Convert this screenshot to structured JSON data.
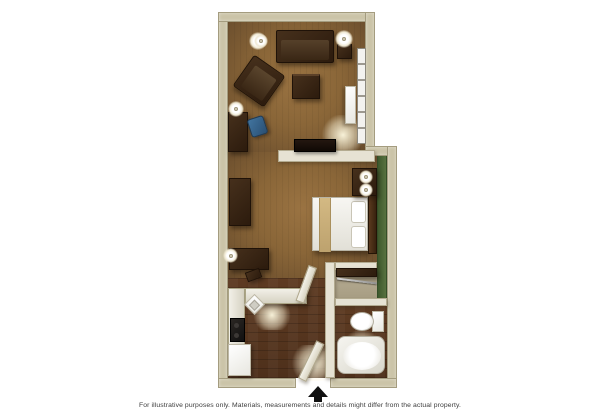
{
  "caption": "For illustrative purposes only.  Materials, measurements and details might differ from the actual property.",
  "floorplan": {
    "rooms": [
      "living-area",
      "bedroom",
      "kitchen",
      "entry-hall",
      "closet",
      "bathroom"
    ],
    "furniture_icons": [
      "sofa",
      "armchair",
      "coffee-table",
      "desk",
      "desk-chair",
      "floor-lamp",
      "table-lamp",
      "wall-lamp",
      "window",
      "ac-unit",
      "tv",
      "side-table",
      "dresser",
      "console-table",
      "bed",
      "pillow",
      "headboard",
      "nightstand",
      "nightstand-lamp",
      "kitchen-counter",
      "kitchen-sink",
      "stove",
      "refrigerator",
      "closet-rod",
      "vanity-counter",
      "toilet",
      "bathtub",
      "entry-door",
      "bathroom-door",
      "entrance-arrow"
    ],
    "colors": {
      "background": "#ffffff",
      "exterior_wall": "#cbc4a8",
      "interior_wall": "#e6e2d3",
      "accent_wall_green": "#587240",
      "carpet_brown": "#8a6638",
      "wood_floor": "#553username4e301b",
      "furniture_dark_brown": "#2c1b0d",
      "bedding_white": "#f4f3ee",
      "bed_runner_tan": "#c8ac7a",
      "counter_white": "#eae8df",
      "desk_chair_blue": "#3c6a93",
      "entrance_arrow_black": "#111111",
      "caption_text": "#3c3c3c"
    }
  }
}
